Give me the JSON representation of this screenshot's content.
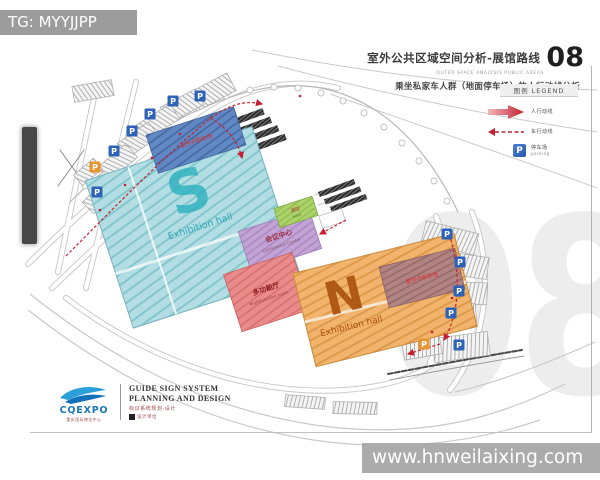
{
  "overlay": {
    "tg_label": "TG: MYYJJPP",
    "site_url": "www.hnweilaixing.com"
  },
  "title_block": {
    "title": "室外公共区域空间分析-展馆路线",
    "subtitle_en": "OUTER SPACE ANALYSIS PUBLIC AREAS",
    "page_no": "08",
    "analysis_line": "乘坐私家车人群（地面停车场）的人行动线分析"
  },
  "legend": {
    "header": "图例 LEGEND",
    "main_route": "人行动线",
    "secondary_route": "车行动线",
    "parking": "停车场",
    "parking_en": "parking"
  },
  "plan": {
    "parking_letter": "P",
    "s_hall_letter": "S",
    "s_hall_name": "Exhibition hall",
    "n_hall_letter": "N",
    "n_hall_name": "Exhibition hall",
    "conference": "会议中心",
    "conference_en": "Conference Center",
    "multifunction": "多功能厅",
    "multifunction_en": "Multifunction room",
    "hotel": "酒店",
    "hotel_en": "hotel",
    "s_outdoor": "室外P停车场",
    "n_outdoor": "室外P停车场"
  },
  "page_watermark": "08",
  "footer": {
    "brand": "CQEXPO",
    "brand_sub": "重庆国际博览中心",
    "line1": "GUIDE SIGN SYSTEM",
    "line2": "PLANNING AND DESIGN",
    "line3": "标识系统规划·设计",
    "agency": "设计单位"
  },
  "colors": {
    "s_hall": "#b2dde2",
    "n_hall": "#f2b46d",
    "conference": "#c2a3d6",
    "multifunction": "#ea8b8b",
    "hotel": "#abd36a",
    "outdoor_band_blue": "#5f88c4",
    "outdoor_band_mauve": "#b18383",
    "route_red": "#c22230",
    "parking_blue": "#2d62b8",
    "parking_orange": "#e8952f"
  }
}
